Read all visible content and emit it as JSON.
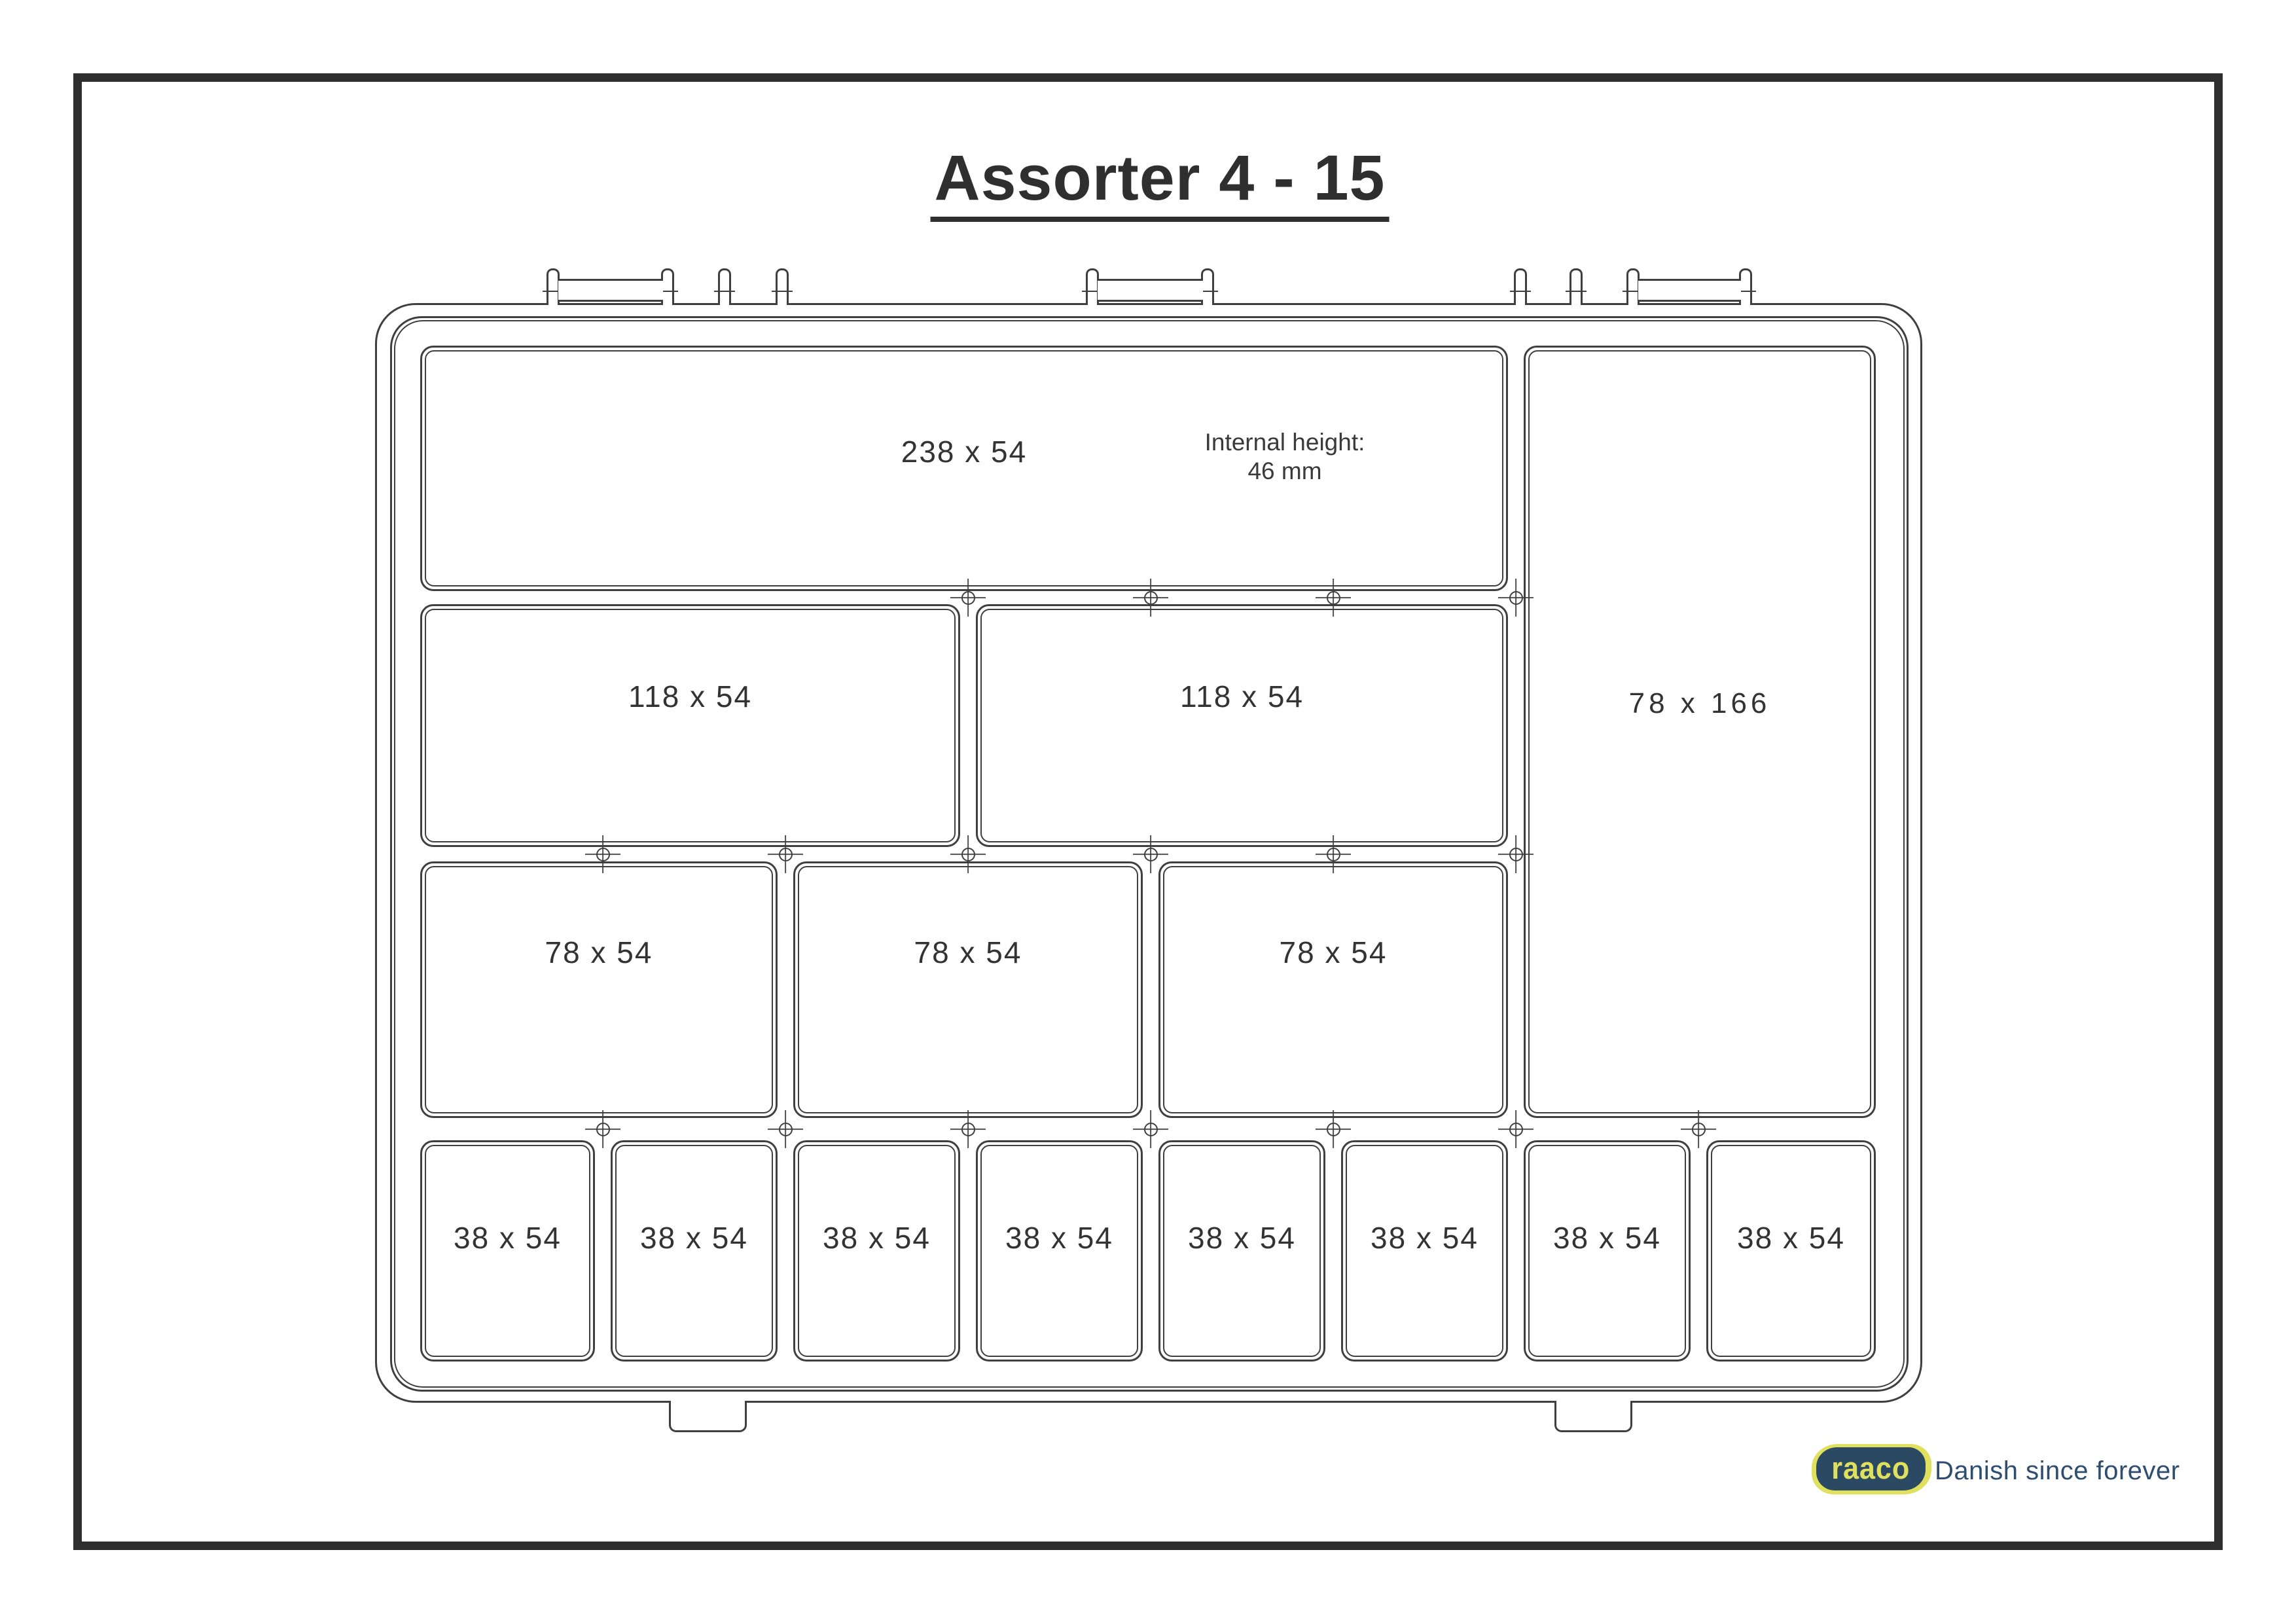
{
  "title": "Assorter 4 - 15",
  "compartments": [
    {
      "label": "238 x 54"
    },
    {
      "label": "78 x 166"
    },
    {
      "label": "118 x 54"
    },
    {
      "label": "118 x 54"
    },
    {
      "label": "78 x 54"
    },
    {
      "label": "78 x 54"
    },
    {
      "label": "78 x 54"
    },
    {
      "label": "38 x 54"
    },
    {
      "label": "38 x 54"
    },
    {
      "label": "38 x 54"
    },
    {
      "label": "38 x 54"
    },
    {
      "label": "38 x 54"
    },
    {
      "label": "38 x 54"
    },
    {
      "label": "38 x 54"
    },
    {
      "label": "38 x 54"
    }
  ],
  "annotation": {
    "line1": "Internal height:",
    "line2": "46 mm"
  },
  "branding": {
    "logo_text": "raaco",
    "tagline": "Danish since forever"
  },
  "colors": {
    "line": "#3f3f3f",
    "text": "#333333",
    "frame": "#2e2e2e",
    "navy": "#2c4963",
    "yellow": "#dfe15e",
    "tagline": "#2e4d71"
  }
}
